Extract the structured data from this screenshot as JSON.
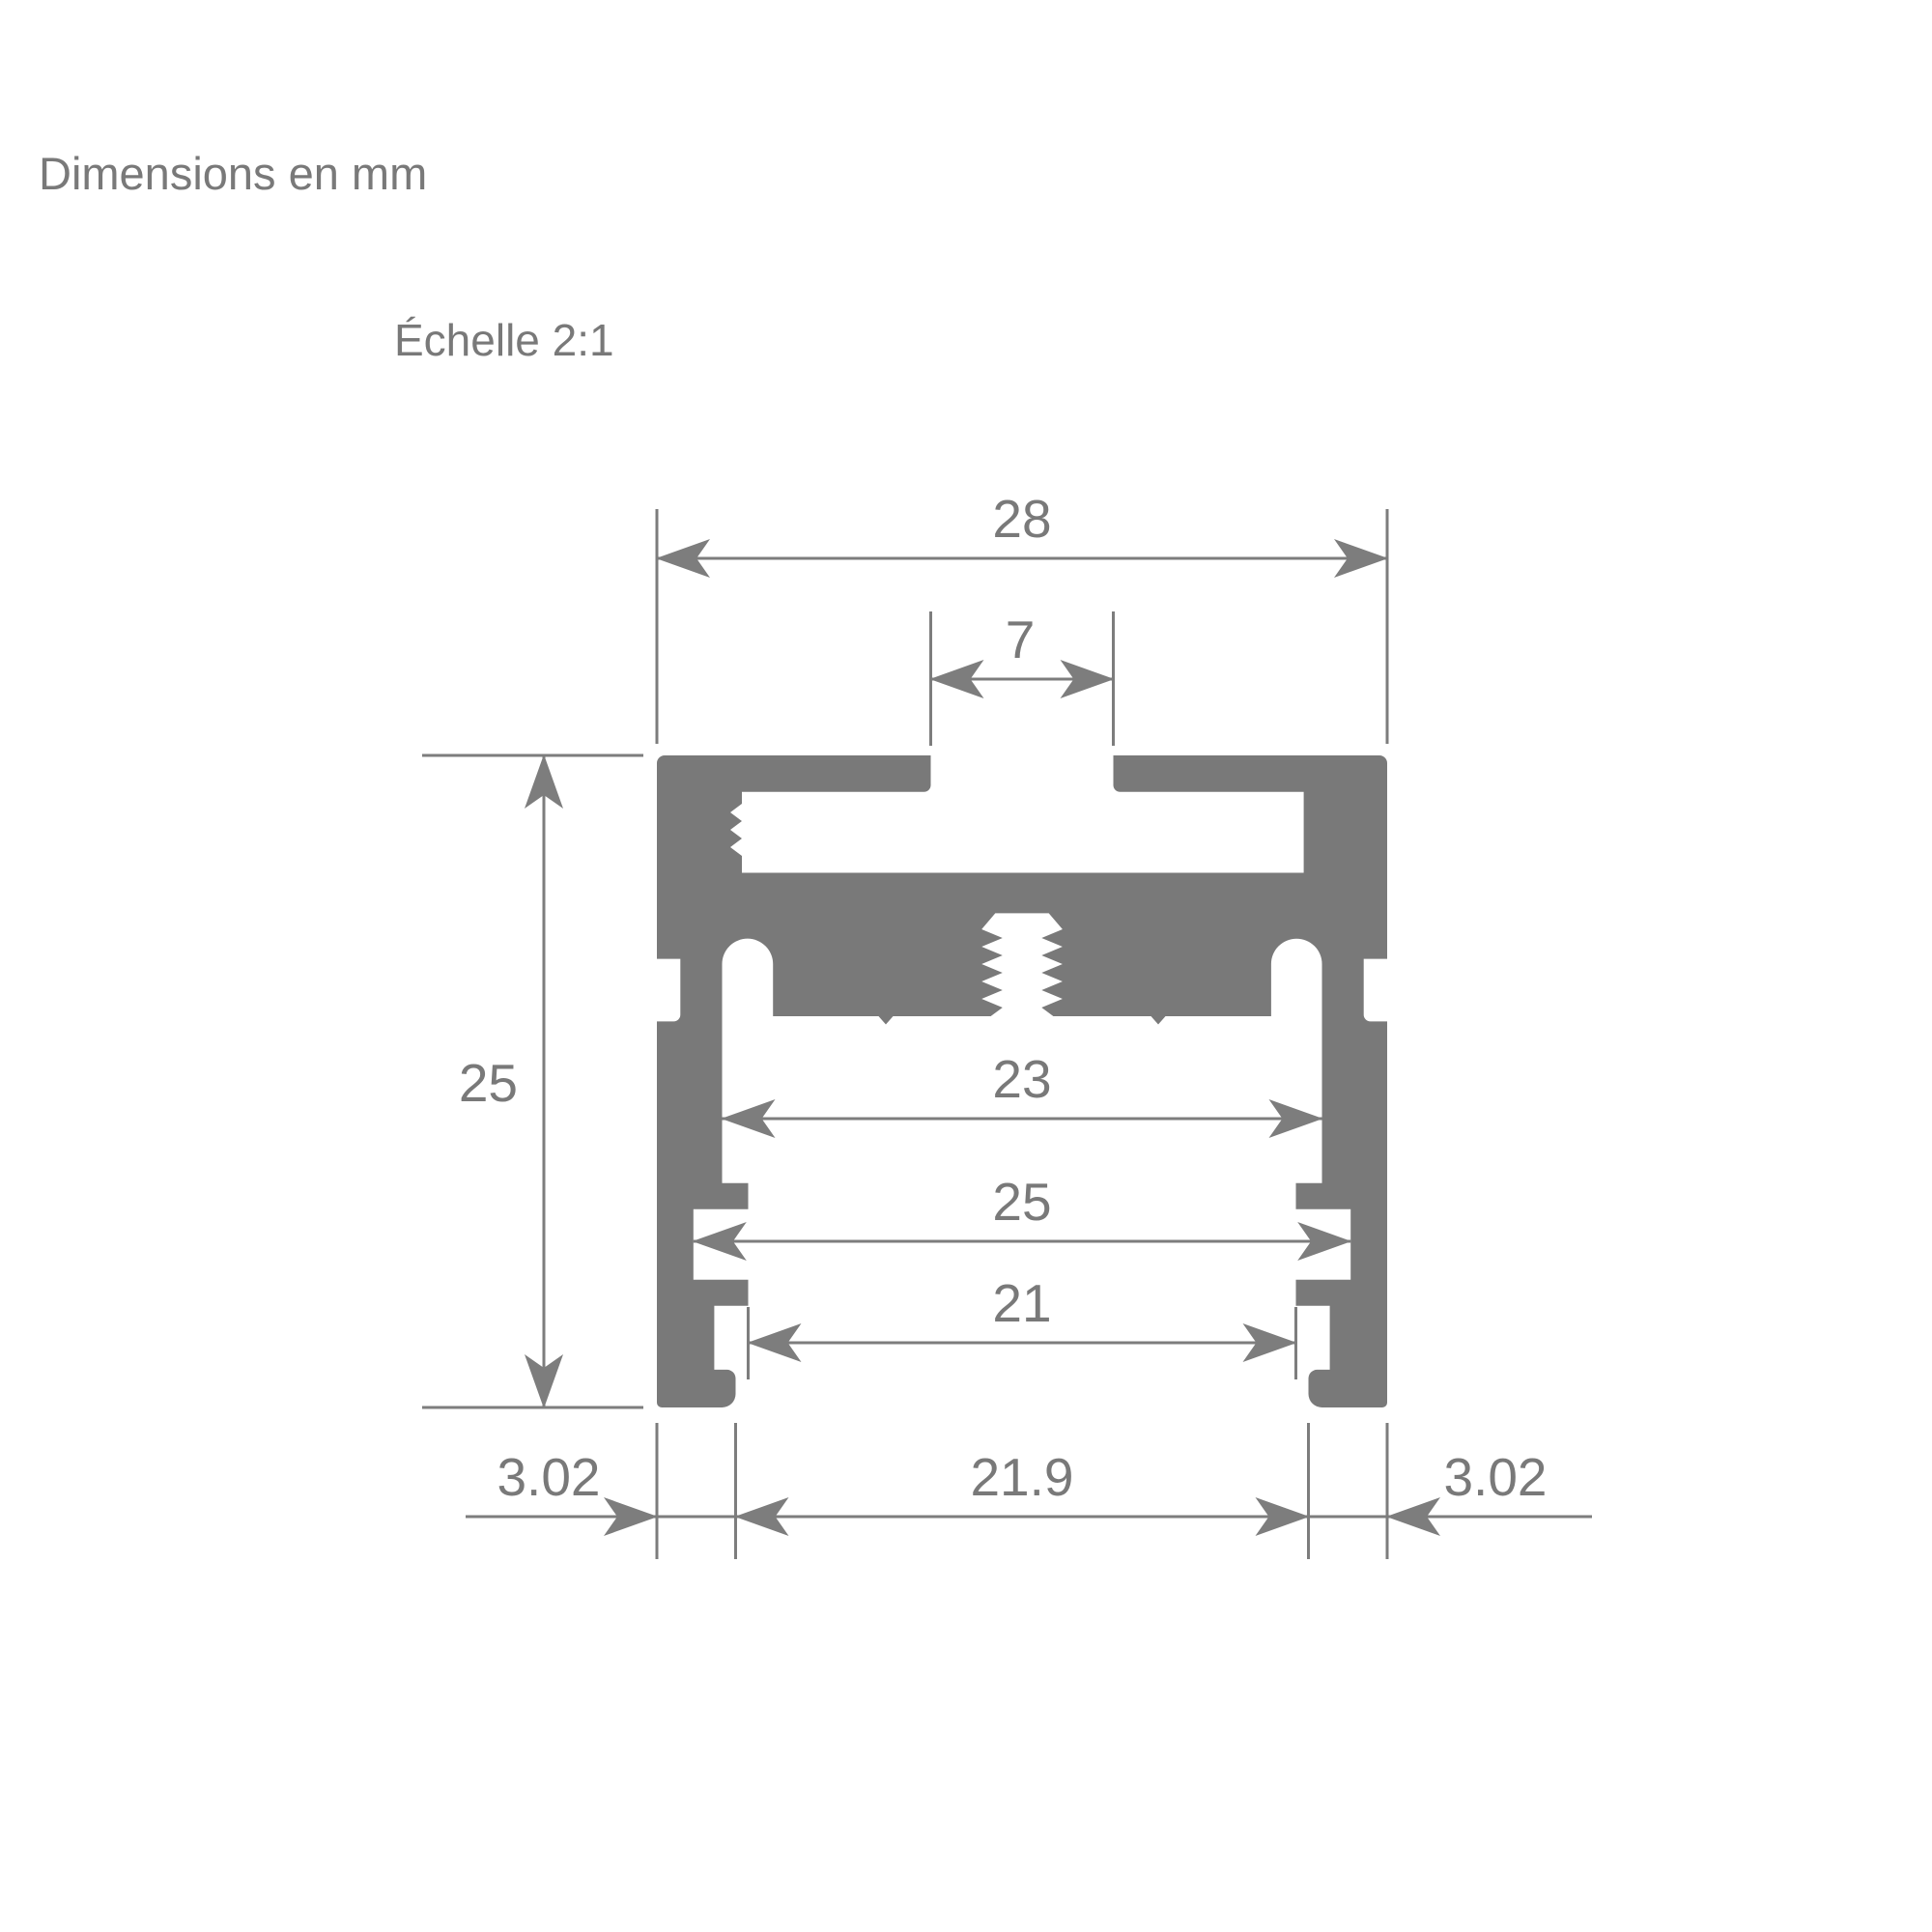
{
  "title": "Dimensions en mm",
  "scale_note": "Échelle 2:1",
  "drawing": {
    "type": "profile-cross-section",
    "units": "mm",
    "scale": "2:1"
  },
  "colors": {
    "ink": "#7d7d7d",
    "fill": "#797979",
    "background": "#ffffff"
  },
  "dimensions": {
    "overall_width": "28",
    "top_slot_width": "7",
    "overall_height": "25",
    "channel_width": "23",
    "groove_width": "25",
    "clip_width": "21",
    "left_foot_width": "3.02",
    "bottom_opening_width": "21.9",
    "right_foot_width": "3.02"
  }
}
